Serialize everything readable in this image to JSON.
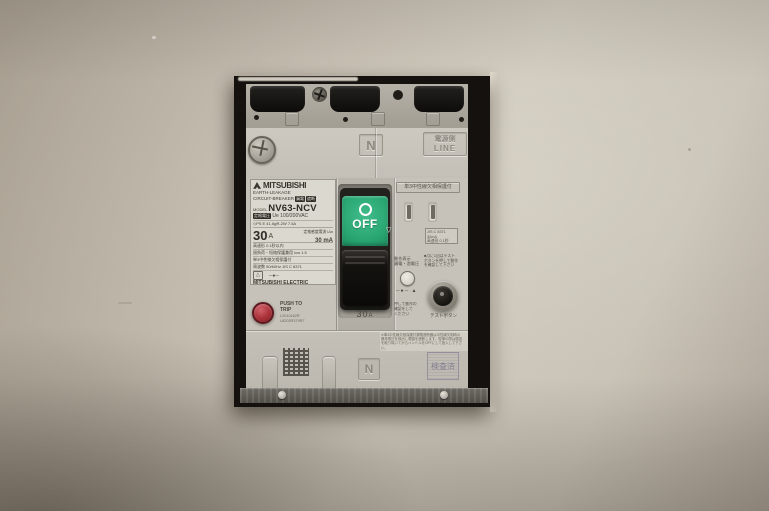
{
  "colors": {
    "wall": "#c3bcae",
    "breaker_face": "#c8c4bb",
    "switch_green": "#2aa873",
    "trip_red": "#a82f37",
    "handle_black": "#14120f"
  },
  "top": {
    "n_label": "N",
    "line_label_line1": "電源側",
    "line_label_line2": "LINE"
  },
  "sticker": {
    "brand": "MITSUBISHI",
    "line_earth": "EARTH-LEAKAGE",
    "line_circuit": "CIRCUIT-BREAKER",
    "chip_a": "漏電",
    "chip_b": "遮断",
    "model_label": "MODEL",
    "model": "NV63-NCV",
    "voltage_chip": "定格電圧",
    "voltage": "Ue 100/200VAC",
    "cert_row": "◇PS E  41   AgR-2W 7.5A",
    "amp": "30",
    "amp_unit": "A",
    "sens_label": "定格感度電流 IΔn",
    "sens_value": "30 mA",
    "row_speed": "高速形 0.1秒以内",
    "row_icw": "過負荷・短絡保護兼用 Icw 1.5",
    "row_neutral": "単3中性線欠相保護付",
    "row_freq": "周波数 50/60Hz  JIS C 8371",
    "sym_left": "△",
    "sym_right": "─●─",
    "maker": "MITSUBISHI ELECTRIC",
    "origin": "MADE IN JAPAN"
  },
  "switch": {
    "off_label": "OFF",
    "arrow": "▽",
    "amp": "30",
    "amp_unit": "A"
  },
  "trip": {
    "line1": "PUSH TO",
    "line2": "TRIP",
    "serial1": "L2010162R",
    "serial2": "L8202R379R7"
  },
  "panel": {
    "title": "単3中性線欠相保護付",
    "spec_line1": "JIS C 8371 30mA",
    "spec_line2": "高速形 0.1秒",
    "spec_line3": "AC100/200V",
    "indicator_label": "動作表示",
    "indicator_sub": "漏電・過電圧",
    "symbols": "─●─ ▲",
    "note_line1": "■月に1回はテスト",
    "note_line2": "ボタンを押して動作",
    "note_line3": "を確認して下さい",
    "press_line1": "押して動作の",
    "press_line2": "確認をして",
    "press_line3": "ください",
    "test_button_label": "テストボタン"
  },
  "lower": {
    "n_label": "N",
    "notice_line1": "※単3中性線欠相保護付漏電遮断器は中性線欠相時の",
    "notice_line2": "異常電圧を検出し電路を遮断します。復帰の際は原因",
    "notice_line3": "を取り除いてからハンドルをOFFにして投入して下さい。",
    "stamp": "検査済"
  }
}
